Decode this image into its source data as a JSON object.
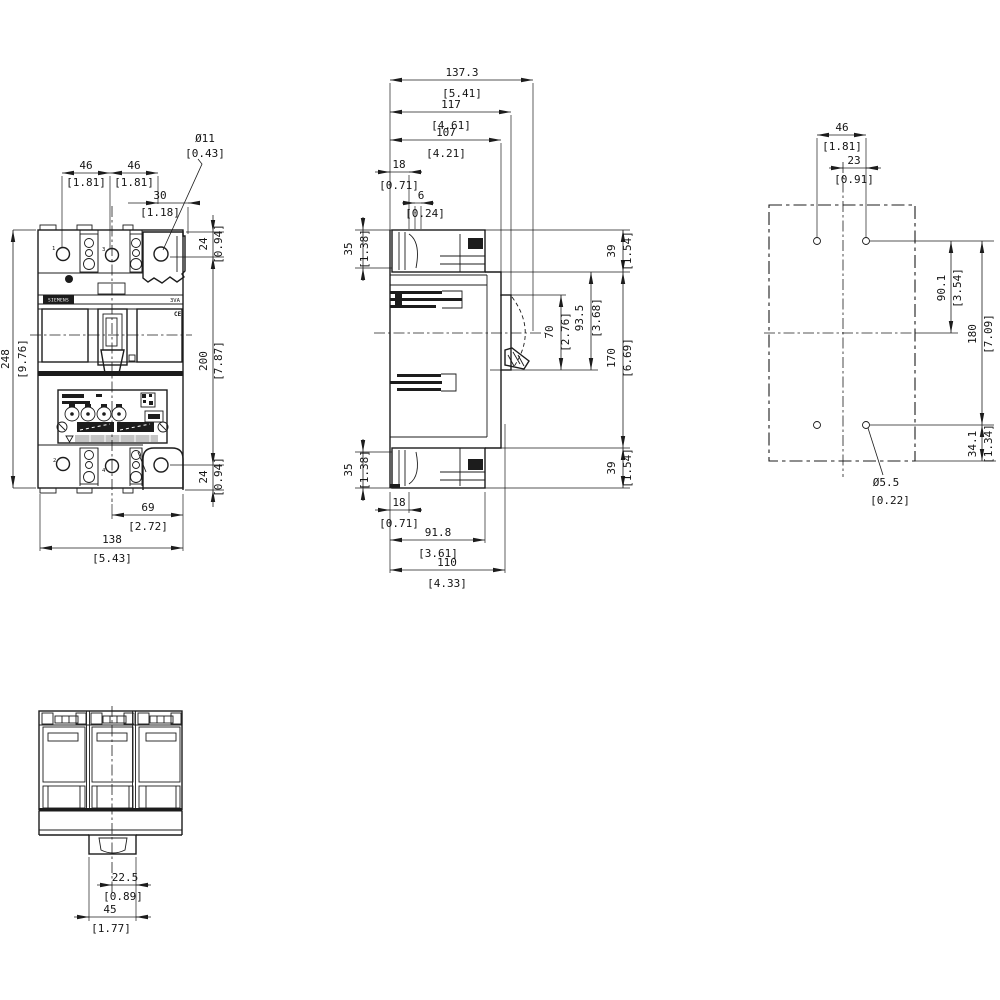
{
  "views": {
    "front": {
      "pole_labels": {
        "p1": "1",
        "p3": "3",
        "p2": "2",
        "p4": "4"
      },
      "brand": "SIEMENS",
      "series": "3VA",
      "ce_mark": "CE",
      "dims": {
        "pole_pitch_1": {
          "mm": "46",
          "inch": "[1.81]"
        },
        "pole_pitch_2": {
          "mm": "46",
          "inch": "[1.81]"
        },
        "lug_hole_offset": {
          "mm": "30",
          "inch": "[1.18]"
        },
        "lug_hole_dia": {
          "mm": "Ø11",
          "inch": "[0.43]"
        },
        "overall_height": {
          "mm": "248",
          "inch": "[9.76]"
        },
        "terminal_hole_top": {
          "mm": "24",
          "inch": "[0.94]"
        },
        "terminal_hole_span": {
          "mm": "200",
          "inch": "[7.87]"
        },
        "terminal_hole_bottom": {
          "mm": "24",
          "inch": "[0.94]"
        },
        "half_width": {
          "mm": "69",
          "inch": "[2.72]"
        },
        "overall_width": {
          "mm": "138",
          "inch": "[5.43]"
        }
      }
    },
    "side": {
      "dims": {
        "overall_depth": {
          "mm": "137.3",
          "inch": "[5.41]"
        },
        "handle_depth": {
          "mm": "117",
          "inch": "[4.61]"
        },
        "cover_depth": {
          "mm": "107",
          "inch": "[4.21]"
        },
        "din_offset_top": {
          "mm": "18",
          "inch": "[0.71]"
        },
        "rail_step": {
          "mm": "6",
          "inch": "[0.24]"
        },
        "terminal_block_top": {
          "mm": "35",
          "inch": "[1.38]"
        },
        "terminal_block_bottom": {
          "mm": "35",
          "inch": "[1.38]"
        },
        "section_top": {
          "mm": "39",
          "inch": "[1.54]"
        },
        "section_middle": {
          "mm": "170",
          "inch": "[6.69]"
        },
        "section_bottom": {
          "mm": "39",
          "inch": "[1.54]"
        },
        "handle_window": {
          "mm": "70",
          "inch": "[2.76]"
        },
        "front_step": {
          "mm": "93.5",
          "inch": "[3.68]"
        },
        "din_offset_bottom": {
          "mm": "18",
          "inch": "[0.71]"
        },
        "body_depth": {
          "mm": "91.8",
          "inch": "[3.61]"
        },
        "base_depth": {
          "mm": "110",
          "inch": "[4.33]"
        }
      }
    },
    "drilling_plan": {
      "dims": {
        "hole_pitch_h": {
          "mm": "46",
          "inch": "[1.81]"
        },
        "half_pitch": {
          "mm": "23",
          "inch": "[0.91]"
        },
        "upper_half": {
          "mm": "90.1",
          "inch": "[3.54]"
        },
        "hole_pitch_v": {
          "mm": "180",
          "inch": "[7.09]"
        },
        "bottom_edge": {
          "mm": "34.1",
          "inch": "[1.34]"
        },
        "hole_dia": {
          "mm": "Ø5.5",
          "inch": "[0.22]"
        }
      }
    },
    "bottom": {
      "dims": {
        "rail_half_offset": {
          "mm": "22.5",
          "inch": "[0.89]"
        },
        "rail_slot_width": {
          "mm": "45",
          "inch": "[1.77]"
        }
      }
    }
  }
}
